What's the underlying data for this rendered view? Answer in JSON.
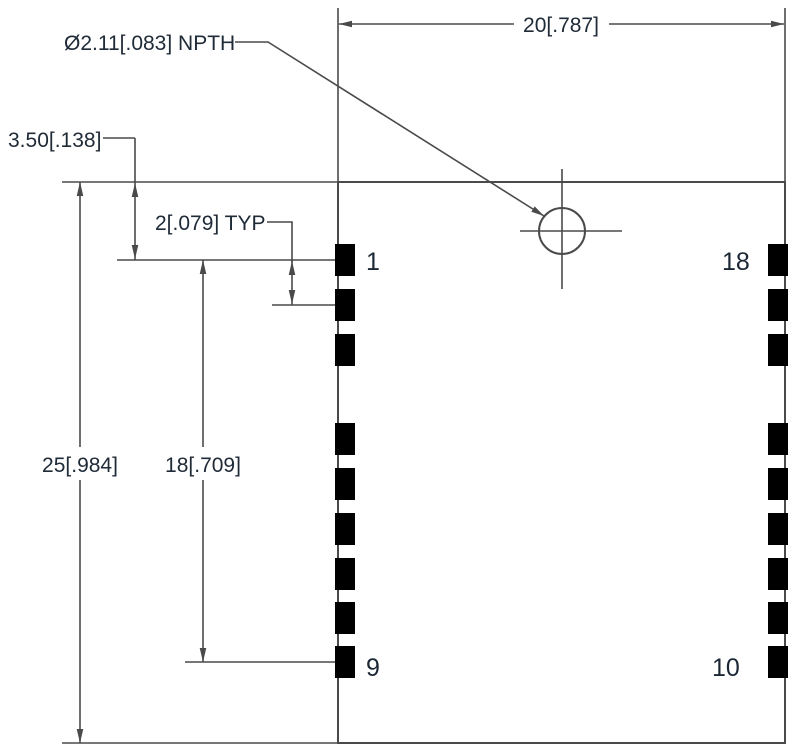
{
  "drawing": {
    "hole_callout": "Ø2.11[.083] NPTH",
    "dim_width": "20[.787]",
    "dim_height": "25[.984]",
    "dim_pin_span": "18[.709]",
    "dim_pin1_offset": "3.50[.138]",
    "dim_pad_pitch": "2[.079] TYP",
    "pins": {
      "top_left": "1",
      "top_right": "18",
      "bottom_left": "9",
      "bottom_right": "10"
    },
    "colors": {
      "line": "#4a4a4a",
      "text": "#202b38",
      "background": "#ffffff"
    }
  }
}
